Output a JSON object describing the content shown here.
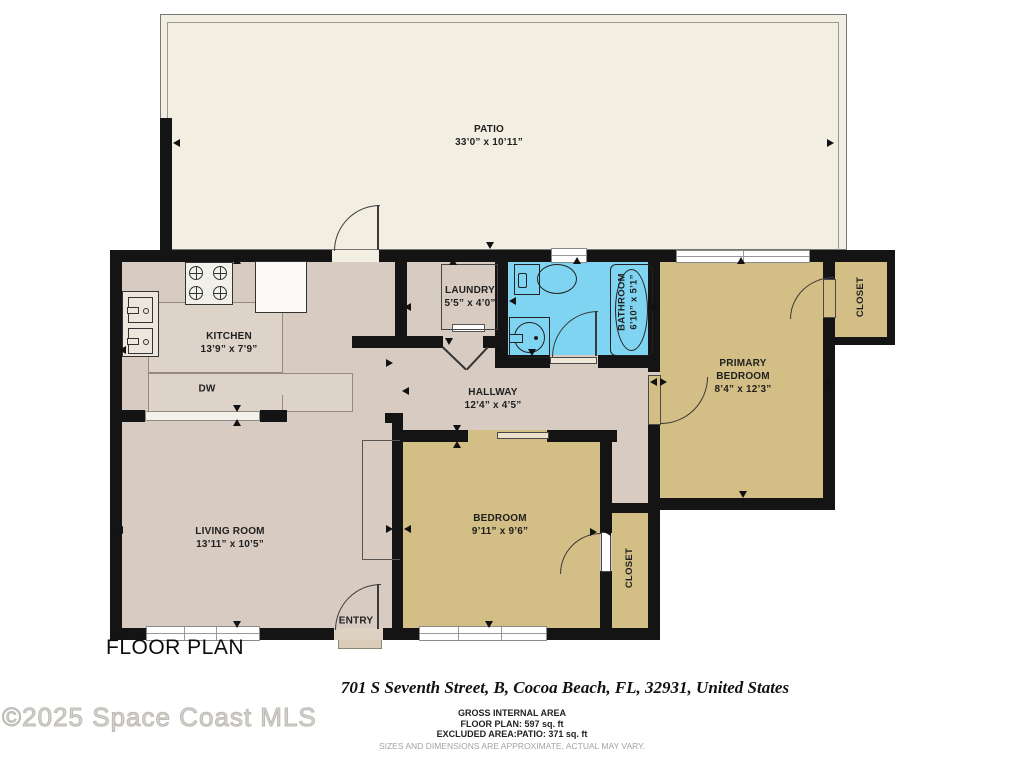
{
  "title": "FLOOR PLAN",
  "address": "701 S Seventh Street, B, Cocoa Beach, FL, 32931, United States",
  "watermark": "©2025 Space Coast MLS",
  "footer": {
    "gross_internal_area": "GROSS INTERNAL AREA",
    "floor_plan_area": "FLOOR PLAN: 597 sq. ft",
    "excluded_area": "EXCLUDED AREA:PATIO: 371 sq. ft",
    "disclaimer": "SIZES AND DIMENSIONS ARE APPROXIMATE, ACTUAL MAY VARY."
  },
  "rooms": {
    "patio": {
      "name": "PATIO",
      "dims": "33’0” x 10’11”"
    },
    "kitchen": {
      "name": "KITCHEN",
      "dims": "13’9” x 7’9”"
    },
    "laundry": {
      "name": "LAUNDRY",
      "dims": "5’5” x 4’0”"
    },
    "bathroom": {
      "name": "BATHROOM",
      "dims": "6’10” x 5’1”"
    },
    "hallway": {
      "name": "HALLWAY",
      "dims": "12’4” x 4’5”"
    },
    "living_room": {
      "name": "LIVING ROOM",
      "dims": "13’11” x 10’5”"
    },
    "bedroom": {
      "name": "BEDROOM",
      "dims": "9’11” x 9’6”"
    },
    "primary_bedroom": {
      "name": "PRIMARY BEDROOM",
      "dims": "8’4” x 12’3”"
    },
    "primary_closet": {
      "name": "CLOSET"
    },
    "bedroom_closet": {
      "name": "CLOSET"
    },
    "entry": {
      "name": "ENTRY"
    },
    "dishwasher": {
      "name": "DW"
    }
  },
  "colors": {
    "floor_main": "#d8ccc2",
    "floor_bedroom": "#d3bf85",
    "bathroom_blue": "#7fd4f1",
    "patio_cream": "#f2efe2",
    "wall": "#141414"
  }
}
